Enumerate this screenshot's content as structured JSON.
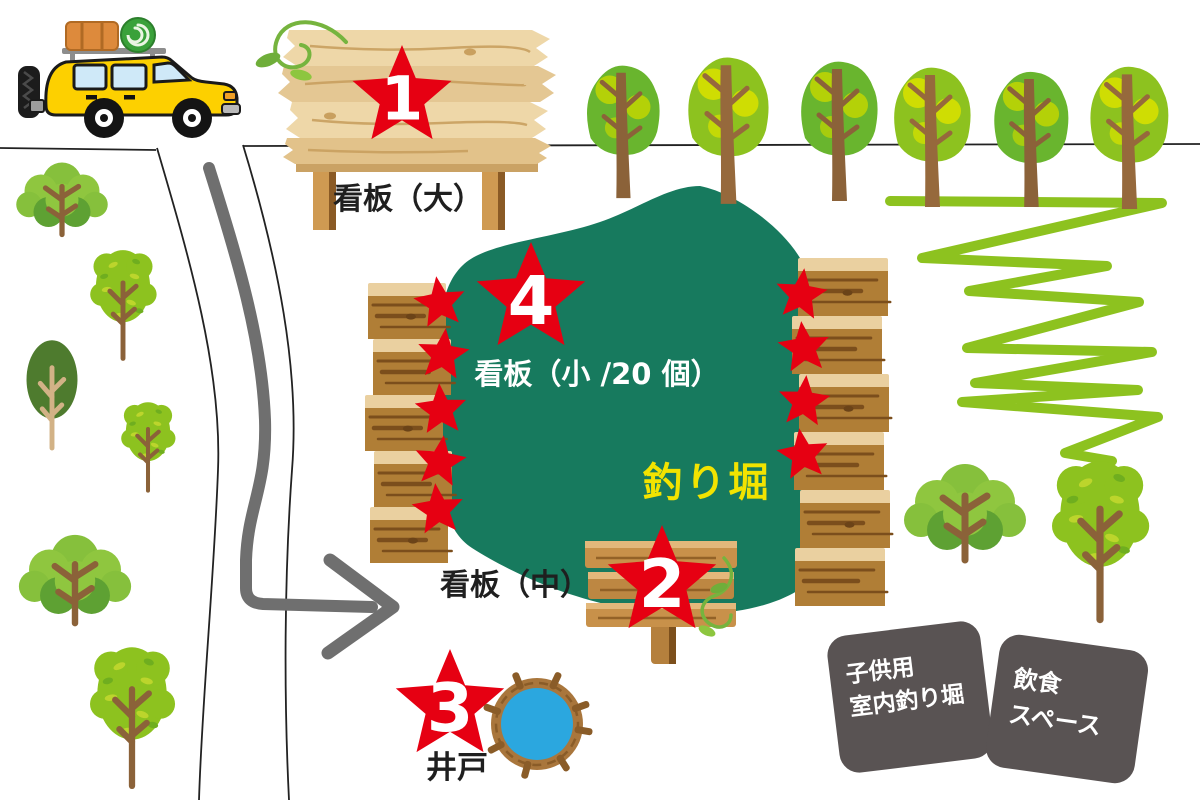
{
  "colors": {
    "star_red": "#e60012",
    "pond_teal": "#177a5e",
    "pond_label_yellow": "#f2e300",
    "badge_gray": "#595353",
    "path_gray": "#6f6f6f",
    "outline_black": "#222222",
    "zigzag_green": "#8dc21f",
    "well_blue": "#2ba7df",
    "wood_light": "#ead0a0",
    "wood_dark": "#b07e36",
    "car_yellow": "#fdd000"
  },
  "labels": {
    "sign_large": "看板（大）",
    "sign_small": "看板（小 /20 個）",
    "sign_medium": "看板（中）",
    "pond": "釣り堀",
    "well": "井戸",
    "kids_line1": "子供用",
    "kids_line2": "室内釣り堀",
    "food_line1": "飲食",
    "food_line2": "スペース"
  },
  "markers": [
    {
      "number": "1",
      "x": 402,
      "y": 97,
      "r": 52
    },
    {
      "number": "2",
      "x": 662,
      "y": 582,
      "r": 57
    },
    {
      "number": "3",
      "x": 450,
      "y": 706,
      "r": 57
    },
    {
      "number": "4",
      "x": 531,
      "y": 299,
      "r": 57
    }
  ],
  "scene": {
    "small_star_r": 27,
    "small_stars": [
      {
        "x": 440,
        "y": 303,
        "rot": -8
      },
      {
        "x": 443,
        "y": 355,
        "rot": 6
      },
      {
        "x": 441,
        "y": 410,
        "rot": -4
      },
      {
        "x": 440,
        "y": 462,
        "rot": 8
      },
      {
        "x": 438,
        "y": 510,
        "rot": -6
      },
      {
        "x": 801,
        "y": 295,
        "rot": 7
      },
      {
        "x": 804,
        "y": 348,
        "rot": -6
      },
      {
        "x": 804,
        "y": 402,
        "rot": 5
      },
      {
        "x": 803,
        "y": 455,
        "rot": -8
      }
    ],
    "trees": [
      {
        "v": "d1",
        "x": 622,
        "y": 200,
        "s": 0.95
      },
      {
        "v": "d2",
        "x": 727,
        "y": 206,
        "s": 1.05
      },
      {
        "v": "d1",
        "x": 838,
        "y": 203,
        "s": 1.0
      },
      {
        "v": "d2",
        "x": 931,
        "y": 209,
        "s": 1.0
      },
      {
        "v": "d1",
        "x": 1030,
        "y": 209,
        "s": 0.97
      },
      {
        "v": "d2",
        "x": 1128,
        "y": 211,
        "s": 1.02
      },
      {
        "v": "a",
        "x": 62,
        "y": 236,
        "s": 0.75
      },
      {
        "v": "b",
        "x": 123,
        "y": 360,
        "s": 0.82
      },
      {
        "v": "c",
        "x": 52,
        "y": 450,
        "s": 0.98
      },
      {
        "v": "b",
        "x": 148,
        "y": 492,
        "s": 0.67
      },
      {
        "v": "a",
        "x": 75,
        "y": 625,
        "s": 0.92
      },
      {
        "v": "b",
        "x": 132,
        "y": 788,
        "s": 1.05
      },
      {
        "v": "a",
        "x": 965,
        "y": 562,
        "s": 1.0
      },
      {
        "v": "b",
        "x": 1100,
        "y": 622,
        "s": 1.2
      }
    ],
    "zigzag": [
      [
        890,
        201
      ],
      [
        1162,
        203
      ],
      [
        922,
        258
      ],
      [
        1107,
        266
      ],
      [
        969,
        291
      ],
      [
        1139,
        302
      ],
      [
        967,
        348
      ],
      [
        1152,
        352
      ],
      [
        975,
        383
      ],
      [
        1138,
        390
      ],
      [
        962,
        402
      ],
      [
        1158,
        417
      ],
      [
        1065,
        453
      ],
      [
        1112,
        461
      ]
    ],
    "plank_stacks": [
      {
        "x": 368,
        "y": 283,
        "w": 78,
        "uh": 56,
        "units": 5,
        "dx": [
          0,
          5,
          -3,
          6,
          2
        ]
      },
      {
        "x": 794,
        "y": 258,
        "w": 90,
        "uh": 58,
        "units": 6,
        "dx": [
          4,
          -2,
          5,
          0,
          6,
          1
        ]
      }
    ]
  }
}
